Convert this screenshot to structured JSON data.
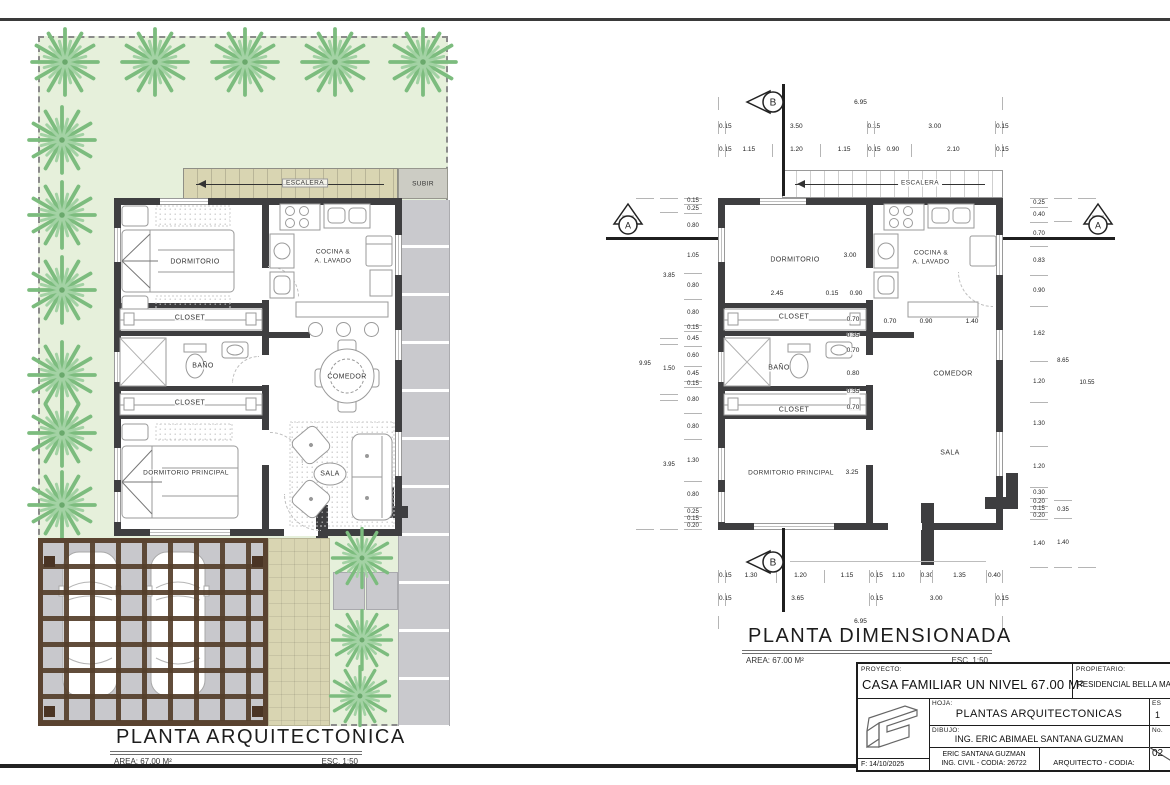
{
  "colors": {
    "garden_green": "#e6f0db",
    "wall_dark": "#3e3e40",
    "stairs_tan": "#d9d5b2",
    "stone_gray": "#c9c9cd",
    "tree_green": "#7cbc7e",
    "pergola_brown": "#5a4330"
  },
  "left_plan": {
    "title": "PLANTA ARQUITECTONICA",
    "area": "AREA: 67.00 M²",
    "scale": "ESC. 1:50",
    "labels": {
      "escalera": "ESCALERA",
      "subir": "SUBIR",
      "dormitorio": "DORMITORIO",
      "closet_a": "CLOSET",
      "bano": "BAÑO",
      "closet_b": "CLOSET",
      "dormitorio_principal": "DORMITORIO PRINCIPAL",
      "cocina_1": "COCINA &",
      "cocina_2": "A. LAVADO",
      "comedor": "COMEDOR",
      "sala": "SALA"
    }
  },
  "right_plan": {
    "title": "PLANTA DIMENSIONADA",
    "area": "AREA: 67.00 M²",
    "scale": "ESC. 1:50",
    "labels": {
      "escalera": "ESCALERA",
      "dormitorio": "DORMITORIO",
      "closet_a": "CLOSET",
      "bano": "BAÑO",
      "closet_b": "CLOSET",
      "dormitorio_principal": "DORMITORIO PRINCIPAL",
      "cocina_1": "COCINA &",
      "cocina_2": "A. LAVADO",
      "comedor": "COMEDOR",
      "sala": "SALA"
    },
    "markers": {
      "a": "A",
      "b": "B"
    },
    "dims": {
      "top_overall": [
        {
          "n": 6.95,
          "t": "6.95"
        }
      ],
      "top_main": [
        {
          "n": 0.15,
          "t": "0.15"
        },
        {
          "n": 3.5,
          "t": "3.50"
        },
        {
          "n": 0.15,
          "t": "0.15"
        },
        {
          "n": 3.0,
          "t": "3.00"
        },
        {
          "n": 0.15,
          "t": "0.15"
        }
      ],
      "top_detail": [
        {
          "n": 0.15,
          "t": "0.15"
        },
        {
          "n": 1.15,
          "t": "1.15"
        },
        {
          "n": 1.2,
          "t": "1.20"
        },
        {
          "n": 1.15,
          "t": "1.15"
        },
        {
          "n": 0.15,
          "t": "0.15"
        },
        {
          "n": 0.9,
          "t": "0.90"
        },
        {
          "n": 2.1,
          "t": "2.10"
        },
        {
          "n": 0.15,
          "t": "0.15"
        }
      ],
      "bottom_detail": [
        {
          "n": 0.15,
          "t": "0.15"
        },
        {
          "n": 1.3,
          "t": "1.30"
        },
        {
          "n": 1.2,
          "t": "1.20"
        },
        {
          "n": 1.15,
          "t": "1.15"
        },
        {
          "n": 0.15,
          "t": "0.15"
        },
        {
          "n": 1.1,
          "t": "1.10"
        },
        {
          "n": 0.3,
          "t": "0.30"
        },
        {
          "n": 1.35,
          "t": "1.35"
        },
        {
          "n": 0.4,
          "t": "0.40"
        }
      ],
      "bottom_main": [
        {
          "n": 0.15,
          "t": "0.15"
        },
        {
          "n": 3.65,
          "t": "3.65"
        },
        {
          "n": 0.15,
          "t": "0.15"
        },
        {
          "n": 3.0,
          "t": "3.00"
        },
        {
          "n": 0.15,
          "t": "0.15"
        }
      ],
      "bottom_overall": [
        {
          "n": 6.95,
          "t": "6.95"
        }
      ],
      "left_inner": [
        {
          "n": 0.15,
          "t": "0.15"
        },
        {
          "n": 0.25,
          "t": "0.25"
        },
        {
          "n": 0.8,
          "t": "0.80"
        },
        {
          "n": 1.05,
          "t": "1.05"
        },
        {
          "n": 0.8,
          "t": "0.80"
        },
        {
          "n": 0.8,
          "t": "0.80"
        },
        {
          "n": 0.15,
          "t": "0.15"
        },
        {
          "n": 0.45,
          "t": "0.45"
        },
        {
          "n": 0.6,
          "t": "0.60"
        },
        {
          "n": 0.45,
          "t": "0.45"
        },
        {
          "n": 0.15,
          "t": "0.15"
        },
        {
          "n": 0.8,
          "t": "0.80"
        },
        {
          "n": 0.8,
          "t": "0.80"
        },
        {
          "n": 1.3,
          "t": "1.30"
        },
        {
          "n": 0.8,
          "t": "0.80"
        },
        {
          "n": 0.25,
          "t": "0.25"
        },
        {
          "n": 0.15,
          "t": "0.15"
        },
        {
          "n": 0.2,
          "t": "0.20"
        }
      ],
      "left_mid": [
        {
          "n": 0.4,
          "t": ""
        },
        {
          "n": 3.85,
          "t": "3.85"
        },
        {
          "n": 0.15,
          "t": ""
        },
        {
          "n": 1.5,
          "t": "1.50"
        },
        {
          "n": 0.15,
          "t": ""
        },
        {
          "n": 3.95,
          "t": "3.95"
        }
      ],
      "left_outer": [
        {
          "n": 9.95,
          "t": "9.95"
        }
      ],
      "right_inner": [
        {
          "n": 0.25,
          "t": "0.25"
        },
        {
          "n": 0.4,
          "t": "0.40"
        },
        {
          "n": 0.7,
          "t": "0.70"
        },
        {
          "n": 0.83,
          "t": "0.83"
        },
        {
          "n": 0.9,
          "t": "0.90"
        },
        {
          "n": 1.62,
          "t": "1.62"
        },
        {
          "n": 1.2,
          "t": "1.20"
        },
        {
          "n": 1.3,
          "t": "1.30"
        },
        {
          "n": 1.2,
          "t": "1.20"
        },
        {
          "n": 0.3,
          "t": "0.30"
        },
        {
          "n": 0.2,
          "t": "0.20"
        },
        {
          "n": 0.15,
          "t": "0.15"
        },
        {
          "n": 0.2,
          "t": "0.20"
        },
        {
          "n": 1.4,
          "t": "1.40"
        }
      ],
      "right_mid": [
        {
          "n": 0.65,
          "t": ""
        },
        {
          "n": 8.2,
          "t": "8.65"
        },
        {
          "n": 0.5,
          "t": "0.35"
        },
        {
          "n": 1.4,
          "t": "1.40"
        }
      ],
      "right_outer": [
        {
          "n": 10.55,
          "t": "10.55"
        }
      ]
    },
    "interior": {
      "dorm_height": "3.00",
      "dorm_width": "2.45",
      "wall": "0.15",
      "pass": "0.90",
      "h1": "0.70",
      "h2": "0.35",
      "h3": "0.70",
      "h4": "0.80",
      "h5": "0.35",
      "h6": "0.70",
      "k1": "0.70",
      "k2": "0.90",
      "k3": "1.40",
      "dp_width": "3.25"
    }
  },
  "title_block": {
    "proyecto_label": "PROYECTO:",
    "proyecto": "CASA FAMILIAR UN NIVEL 67.00 M²",
    "propietario_label": "PROPIETARIO:",
    "propietario": "RESIDENCIAL BELLA MA",
    "hoja_label": "HOJA:",
    "hoja": "PLANTAS ARQUITECTONICAS",
    "dibujo_label": "DIBUJO:",
    "dibujo": "ING. ERIC ABIMAEL SANTANA GUZMAN",
    "firma_ing_1": "ERIC SANTANA GUZMAN",
    "firma_ing_2": "ING. CIVIL - CODIA: 26722",
    "firma_arq": "ARQUITECTO - CODIA:",
    "fecha": "F: 14/10/2025",
    "escala_label": "ES",
    "escala_value": "1",
    "numero_label": "No.",
    "hoja_numero": "02"
  }
}
